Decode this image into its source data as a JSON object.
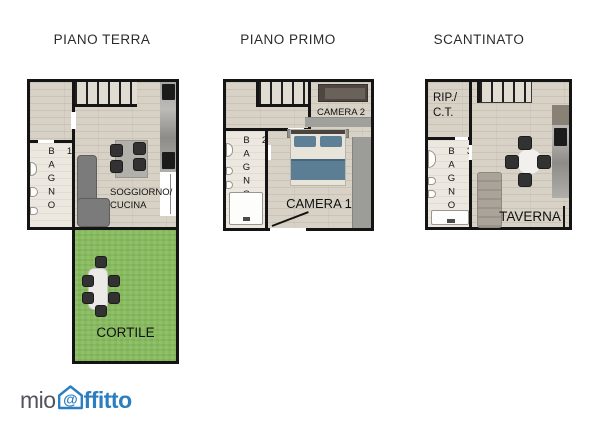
{
  "page": {
    "background": "#ffffff"
  },
  "plans": [
    {
      "title": "PIANO TERRA",
      "rooms": {
        "bagno": "BAGNO 1",
        "soggiorno_line1": "SOGGIORNO/",
        "soggiorno_line2": "CUCINA",
        "cortile": "CORTILE"
      }
    },
    {
      "title": "PIANO PRIMO",
      "rooms": {
        "bagno": "BAGNO 2",
        "camera2": "CAMERA 2",
        "camera1": "CAMERA 1"
      }
    },
    {
      "title": "SCANTINATO",
      "rooms": {
        "rip_line1": "RIP./",
        "rip_line2": "C.T.",
        "bagno": "BAGNO 3",
        "taverna": "TAVERNA"
      }
    }
  ],
  "logo": {
    "mio": "mio",
    "at": "@",
    "affitto": "ffitto"
  },
  "colors": {
    "wall": "#141414",
    "floor": "#d8d2c6",
    "bathroom_floor": "#ece8e0",
    "grass": "#88bb5f",
    "sofa": "#7b7b7b",
    "furniture_dark": "#323232",
    "bed_blanket": "#5c7e94",
    "logo_gray": "#53535b",
    "logo_blue": "#2b7fc0"
  }
}
